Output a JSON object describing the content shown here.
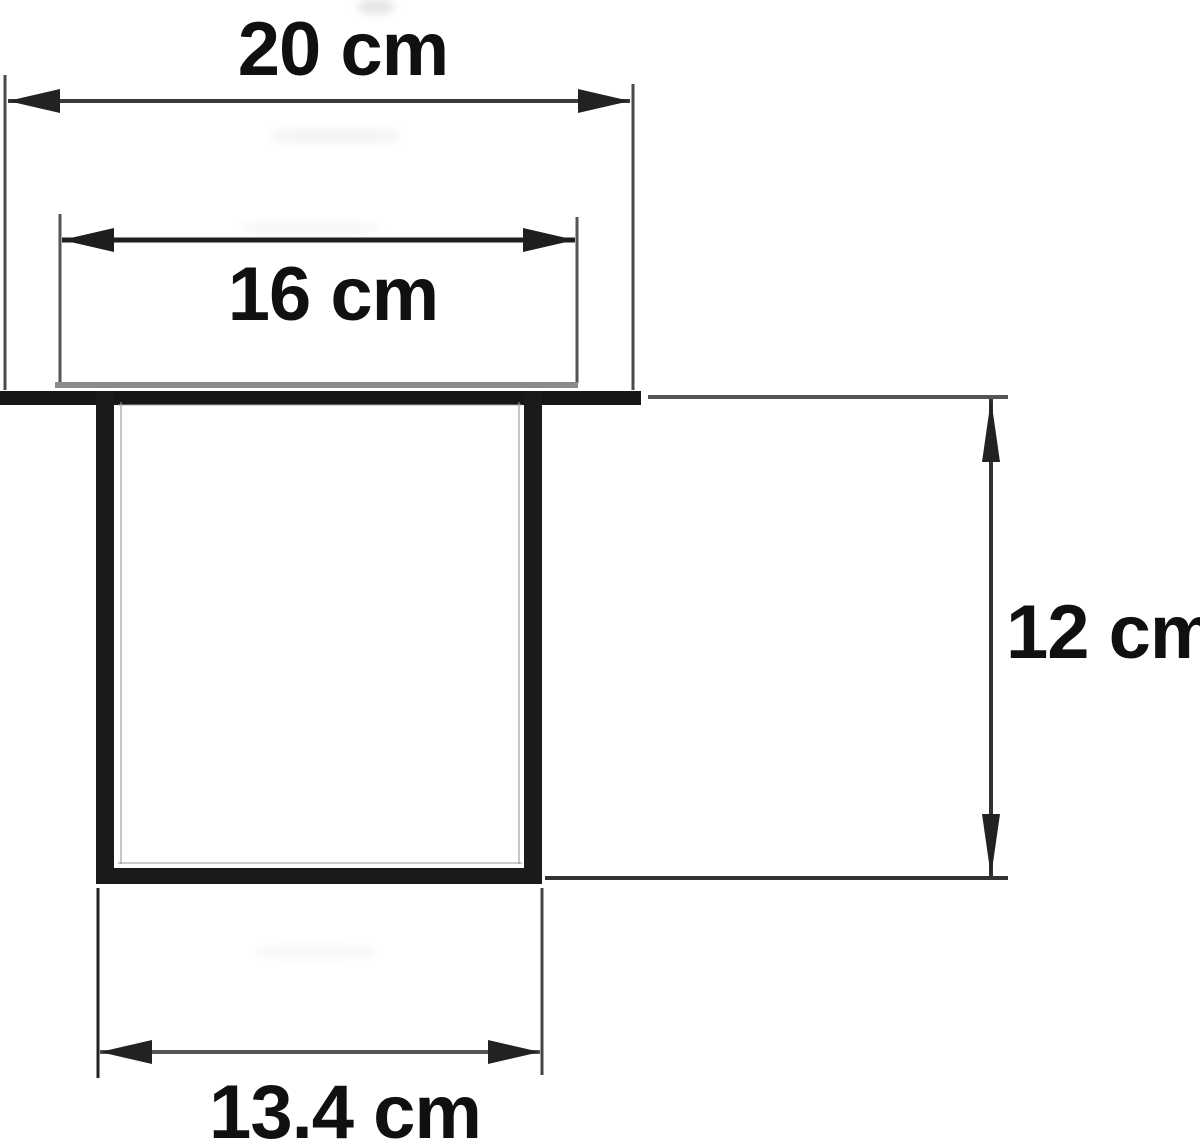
{
  "diagram": {
    "unit": "cm",
    "labels": {
      "top_width": "20 cm",
      "inner_width": "16 cm",
      "height": "12 cm",
      "bottom_width": "13.4 cm"
    },
    "values": {
      "top_width_cm": 20,
      "inner_width_cm": 16,
      "height_cm": 12,
      "bottom_width_cm": 13.4
    },
    "colors": {
      "line": "#2a2a2a",
      "secondary_line": "#8a8a8a",
      "text": "#101010",
      "background": "#ffffff"
    }
  }
}
